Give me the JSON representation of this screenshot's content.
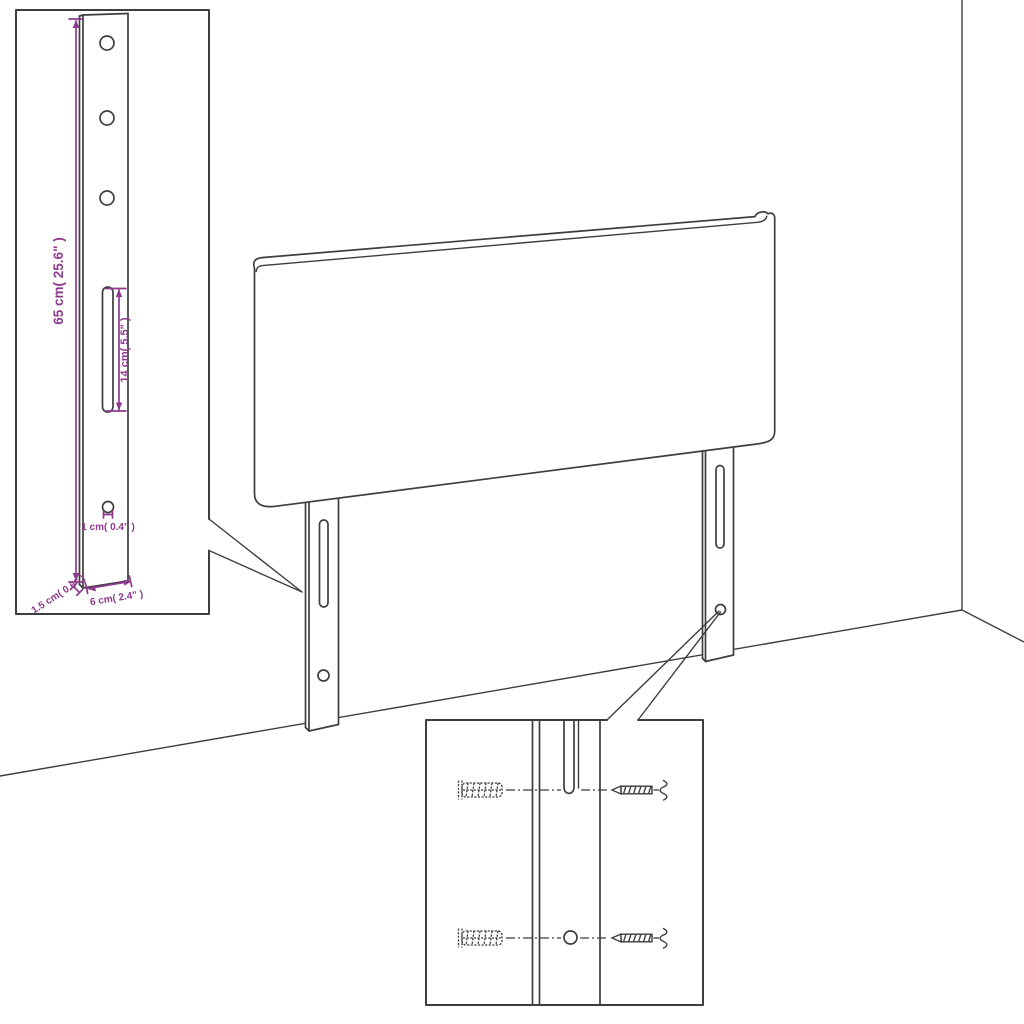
{
  "diagram": {
    "title": "Headboard assembly dimension diagram",
    "colors": {
      "line": "#3e3e3e",
      "dimension": "#8e3a8e",
      "background": "#ffffff"
    },
    "leg_detail": {
      "height_label": "65 cm( 25.6\" )",
      "slot_label": "14 cm( 5.5\" )",
      "hole_label": "1 cm( 0.4\" )",
      "thickness_label": "1.5 cm( 0.6\" )",
      "width_label": "6 cm( 2.4\" )",
      "hole_count": 4,
      "slot_count": 1
    },
    "mounting_detail": {
      "wall_plug_count": 2,
      "screw_count": 2,
      "slot_count": 1,
      "hole_count": 1
    }
  }
}
